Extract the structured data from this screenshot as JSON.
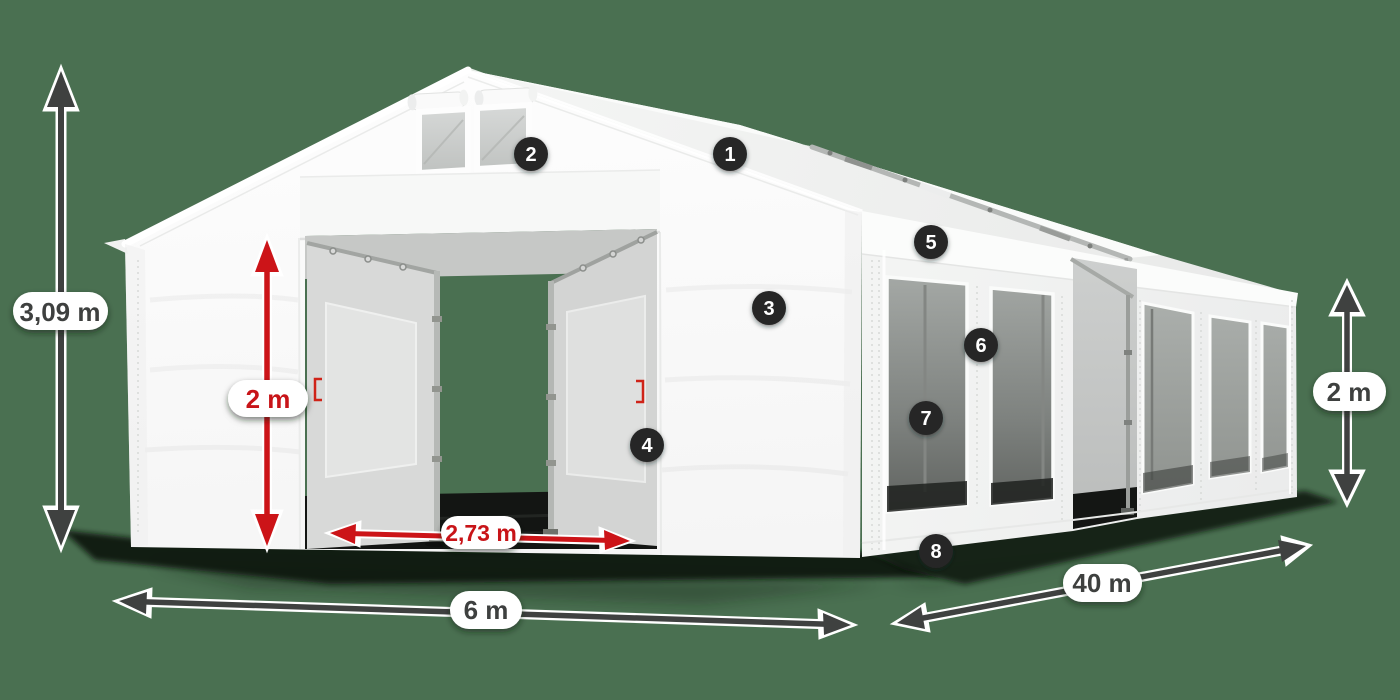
{
  "scene": {
    "description": "White PVC storage tent 6 x 40 m dimension diagram with numbered feature markers",
    "background_color": "#4A7051"
  },
  "markers": [
    {
      "label": "1"
    },
    {
      "label": "2"
    },
    {
      "label": "3"
    },
    {
      "label": "4"
    },
    {
      "label": "5"
    },
    {
      "label": "6"
    },
    {
      "label": "7"
    },
    {
      "label": "8"
    }
  ],
  "dimensions": {
    "total_height": "3,09 m",
    "door_height": "2 m",
    "door_width": "2,73 m",
    "tent_width": "6 m",
    "tent_length": "40 m",
    "side_wall_height": "2 m"
  },
  "colors": {
    "background": "#4A7051",
    "label_text_dark": "#3E403F",
    "label_text_red": "#C81418",
    "arrow_dark": "#3F4140",
    "arrow_red": "#CC1418",
    "marker_fill": "#272727",
    "marker_text": "#FFFFFF",
    "pill_fill": "#FFFFFF"
  }
}
